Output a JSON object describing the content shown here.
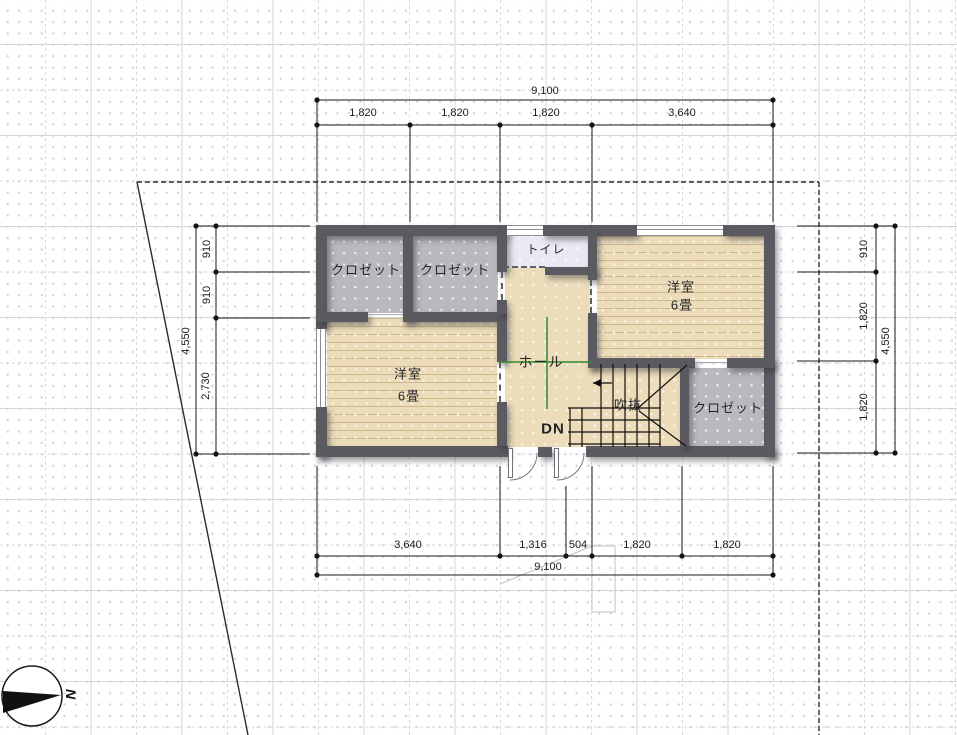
{
  "rooms": {
    "closet_tl1": "クロゼット",
    "closet_tl2": "クロゼット",
    "toilet": "トイレ",
    "bedroom_right_name": "洋室",
    "bedroom_right_size": "6畳",
    "bedroom_left_name": "洋室",
    "bedroom_left_size": "6畳",
    "hall": "ホール",
    "stair_void": "吹抜",
    "stair_down": "DN",
    "closet_br": "クロゼット"
  },
  "dims": {
    "top_overall": "9,100",
    "top_seg1": "1,820",
    "top_seg2": "1,820",
    "top_seg3": "1,820",
    "top_seg4": "3,640",
    "bottom_seg1": "3,640",
    "bottom_seg2": "1,316",
    "bottom_seg3": "504",
    "bottom_seg4": "1,820",
    "bottom_seg5": "1,820",
    "bottom_overall": "9,100",
    "left_overall": "4,550",
    "left_seg1": "910",
    "left_seg2": "910",
    "left_seg3": "2,730",
    "right_seg1": "910",
    "right_seg2": "1,820",
    "right_seg3": "1,820",
    "right_overall": "4,550"
  },
  "compass": {
    "north_label": "N"
  },
  "colors": {
    "wall": "#5a5a60",
    "wood_floor": "#ecdcba",
    "closet_floor": "#b9b9bd",
    "toilet_floor": "#e9e9f3",
    "marker_green": "#2e8b2e"
  }
}
